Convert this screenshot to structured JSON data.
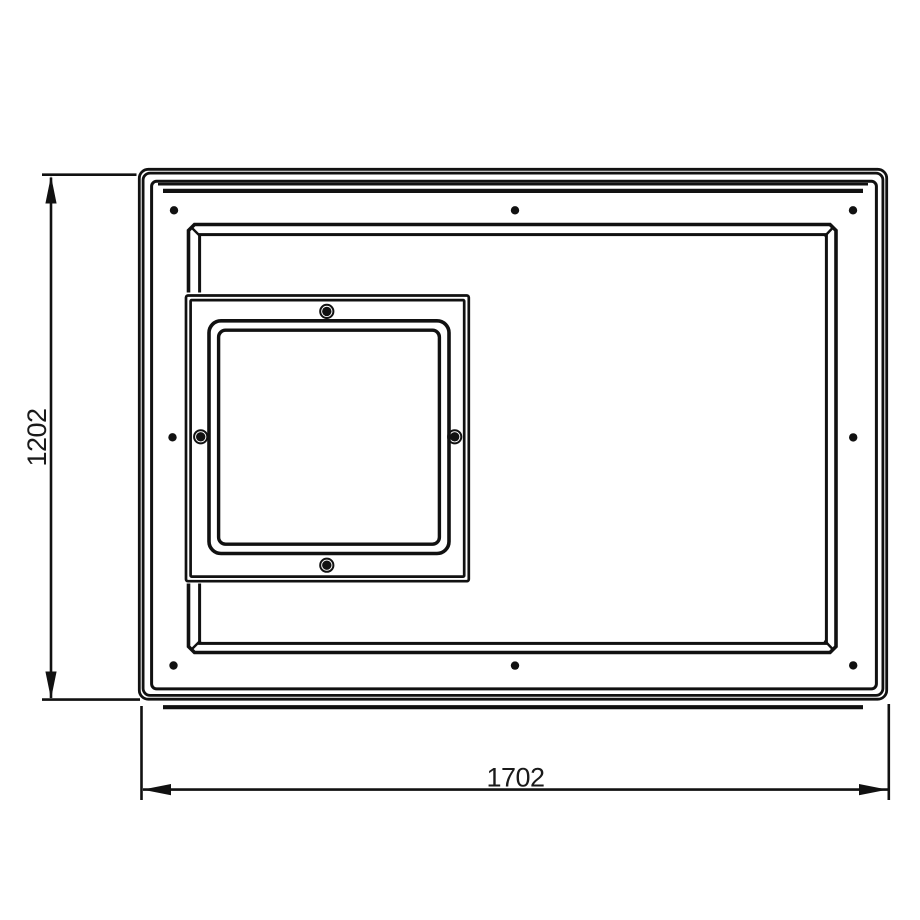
{
  "drawing": {
    "dimension_labels": {
      "height": "1202",
      "width": "1702"
    },
    "colors": {
      "line": "#111111",
      "text": "#1a1a1a",
      "background": "#ffffff"
    },
    "counts": {
      "panel_mounting_holes": 8,
      "square_frame_screws": 4
    }
  }
}
